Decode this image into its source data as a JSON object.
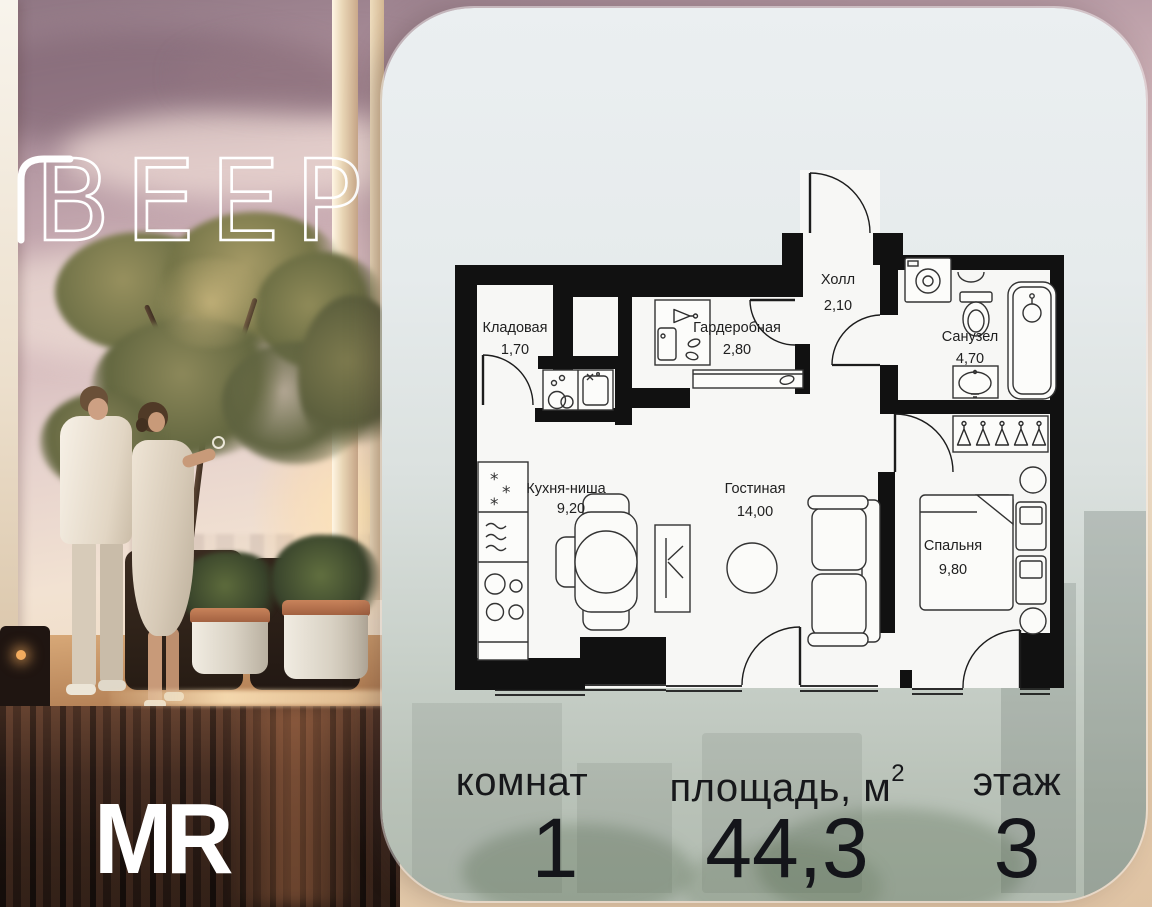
{
  "branding": {
    "project_logo": "ВЕЕР",
    "developer_logo": "MR"
  },
  "floorplan": {
    "rooms": [
      {
        "name": "Кладовая",
        "area": "1,70"
      },
      {
        "name": "Гардеробная",
        "area": "2,80"
      },
      {
        "name": "Холл",
        "area": "2,10"
      },
      {
        "name": "Санузел",
        "area": "4,70"
      },
      {
        "name": "Кухня-ниша",
        "area": "9,20"
      },
      {
        "name": "Гостиная",
        "area": "14,00"
      },
      {
        "name": "Спальня",
        "area": "9,80"
      }
    ]
  },
  "summary": {
    "rooms": {
      "label": "комнат",
      "value": "1"
    },
    "area": {
      "label": "площадь, м",
      "sup": "2",
      "value": "44,3"
    },
    "floor": {
      "label": "этаж",
      "value": "3"
    }
  },
  "colors": {
    "wall": "#111111",
    "room_fill": "#f7f7f5",
    "panel_top": "#ebeff1",
    "panel_bottom": "#b1bbb0",
    "stats_text": "#17181b",
    "logo": "#ffffff"
  }
}
